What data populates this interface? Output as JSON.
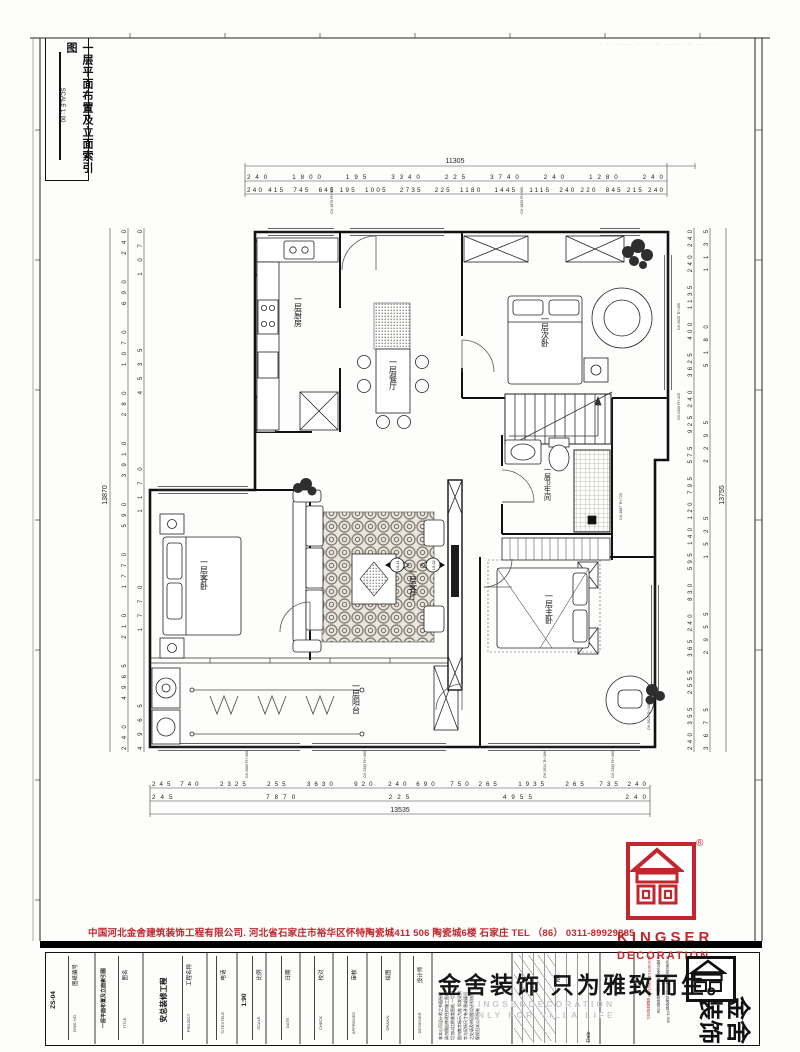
{
  "sheet": {
    "corner_note": "·· ········· ···· ···· ·········· ····· ··"
  },
  "title_box": {
    "title": "一层平面布置及立面索引图",
    "scale": "SCALE 1: 90"
  },
  "plan": {
    "rooms": {
      "kitchen": "一层厨房",
      "dining": "一层餐厅",
      "bed2": "一层次卧",
      "bath": "一层卫生间",
      "guest": "一层客卧",
      "living": "一层客厅",
      "balcony": "一层阳台",
      "master": "一层主卧"
    },
    "dims": {
      "top_total": "11305",
      "top_row2": "240   1800   195   3340   225   3740   240   1280   240",
      "top_row3": "240 415  745  645 195  1005   2735   225  1180   1445   1115  240 220  845 215 240",
      "bottom_row1": "245 740   2325   255   3630   920  240 690  750 265   1935   265  735 240",
      "bottom_row2": "245             7870             225             4955             240",
      "bottom_total": "13535",
      "left_total": "13870",
      "left_row_a": "240  4965  210  1770  590  3910  280  1070  690  240",
      "left_row_b": "4965     1770     1170     4535     1070",
      "right_total": "13755",
      "right_row_a": "240 355  2555  365 240  830  595 140 120 795  575  925 240  3625  400  1135  240 240",
      "right_row_b": "3675    2955    1525    2295    5180    1135"
    },
    "annotations": [
      "CH:1970 FH:950",
      "CH:1820 FH:560",
      "CH:2025 TH:305",
      "CH:2320 FH:325",
      "CH:1687 TH:725",
      "CH:2024 TH:306",
      "CH:2300 FH:360",
      "CH:2024 TH:306",
      "CH:2300 FH:360",
      "CH:2060 FH:360"
    ],
    "markers": {
      "m1": "LS-11",
      "m2": "LS-02"
    }
  },
  "footer": {
    "company_line": "中国河北金舍建筑装饰工程有限公司. 河北省石家庄市裕华区怀特陶瓷城411 506 陶瓷城6楼    石家庄    TEL （86） 0311-89929885",
    "logo": {
      "en1": "KINGSER",
      "en2": "DECORATION",
      "reg": "®"
    },
    "slogan": "金舍装饰 只为雅致而生。",
    "watermark1": "KINGSERDECORATION",
    "watermark2": "ONLY FOR VILLA LIFE",
    "brand_big_right": "金舍",
    "brand_big_left": "装饰",
    "brand_col1": "KINGSER DECORATION 别墅装修设计",
    "brand_col2": "中国河北金舍建筑装饰工程有限公司",
    "brand_col3": "河北省石家庄市裕华区怀特陶瓷城411-506",
    "revision": {
      "no": "NO.",
      "date": "Date"
    },
    "notes": "非本公司设计师之书面授权\n请勿擅自修改任何施工图纸\n切勿以比例量度图纸 一切以\n图内数字标示为准 如发现数\n字与现场尺寸有矛盾或疑问\n之处请及时通知设计师核对\n版权归本公司所有",
    "titleblock": [
      {
        "label_cn": "图纸编号",
        "label_en": "DWG NO.",
        "value": "ZS-04"
      },
      {
        "label_cn": "图名",
        "label_en": "TITLE",
        "value": "一层平面布置及立面索引图"
      },
      {
        "label_cn": "工程名称",
        "label_en": "PROJECT",
        "value": "安总装修工程"
      },
      {
        "label_cn": "电话",
        "label_en": "TLTEXTELE",
        "value": ""
      },
      {
        "label_cn": "比例",
        "label_en": "SCALE",
        "value": "1:90"
      },
      {
        "label_cn": "日期",
        "label_en": "DATE",
        "value": ""
      },
      {
        "label_cn": "校对",
        "label_en": "CHECK",
        "value": ""
      },
      {
        "label_cn": "审核",
        "label_en": "APPROVED",
        "value": ""
      },
      {
        "label_cn": "绘图",
        "label_en": "DRAWN",
        "value": ""
      },
      {
        "label_cn": "设计师",
        "label_en": "DESIGNER",
        "value": ""
      }
    ]
  }
}
